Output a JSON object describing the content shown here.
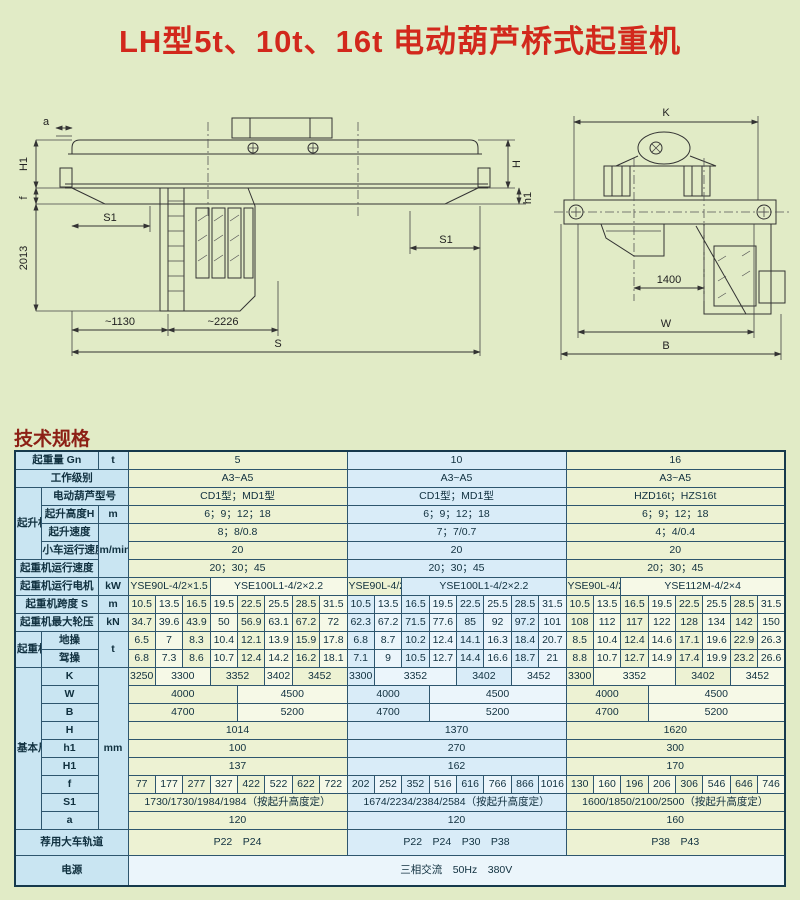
{
  "page": {
    "title": "LH型5t、10t、16t 电动葫芦桥式起重机",
    "section_heading": "技术规格"
  },
  "colors": {
    "title_red": "#d2281c",
    "heading_maroon": "#8c2015",
    "table_border": "#2e566e",
    "label_bg": "#c9e5f2",
    "green_bg": "#edf2d3",
    "blue_bg": "#d9ecf8",
    "page_bg": "#e1ebc6"
  },
  "drawing_left": {
    "name": "bridge crane side view",
    "labels": {
      "dim_a": "a",
      "dim_H1": "H1",
      "dim_f": "f",
      "dim_2013": "2013",
      "dim_S1_left": "S1",
      "dim_1130": "~1130",
      "dim_2226": "~2226",
      "dim_S": "S",
      "dim_H": "H",
      "dim_h1": "h1",
      "dim_S1_right": "S1"
    }
  },
  "drawing_right": {
    "name": "bridge crane end view",
    "labels": {
      "dim_K": "K",
      "dim_1400": "1400",
      "dim_W": "W",
      "dim_B": "B"
    }
  },
  "table": {
    "rows": [
      {
        "cells": [
          {
            "t": "起重量 Gn",
            "c": 2,
            "k": "lab"
          },
          {
            "t": "t",
            "k": "lab"
          },
          {
            "t": "5",
            "c": 8,
            "k": "g"
          },
          {
            "t": "10",
            "c": 8,
            "k": "b"
          },
          {
            "t": "16",
            "c": 8,
            "k": "g"
          }
        ]
      },
      {
        "cells": [
          {
            "t": "工作级别",
            "c": 3,
            "k": "lab"
          },
          {
            "t": "A3~A5",
            "c": 8,
            "k": "g"
          },
          {
            "t": "A3~A5",
            "c": 8,
            "k": "b"
          },
          {
            "t": "A3~A5",
            "c": 8,
            "k": "g"
          }
        ]
      },
      {
        "cells": [
          {
            "t": "起升机构",
            "r": 4,
            "k": "lab"
          },
          {
            "t": "电动葫芦型号",
            "c": 2,
            "k": "lab"
          },
          {
            "t": "CD1型；MD1型",
            "c": 8,
            "k": "g"
          },
          {
            "t": "CD1型；MD1型",
            "c": 8,
            "k": "b"
          },
          {
            "t": "HZD16t；HZS16t",
            "c": 8,
            "k": "g"
          }
        ]
      },
      {
        "cells": [
          {
            "t": "起升高度H",
            "k": "lab"
          },
          {
            "t": "m",
            "k": "lab"
          },
          {
            "t": "6；9；12；18",
            "c": 8,
            "k": "g"
          },
          {
            "t": "6；9；12；18",
            "c": 8,
            "k": "b"
          },
          {
            "t": "6；9；12；18",
            "c": 8,
            "k": "g"
          }
        ]
      },
      {
        "cells": [
          {
            "t": "起升速度",
            "k": "lab"
          },
          {
            "t": "m/min",
            "r": 3,
            "k": "lab"
          },
          {
            "t": "8；8/0.8",
            "c": 8,
            "k": "g"
          },
          {
            "t": "7；7/0.7",
            "c": 8,
            "k": "b"
          },
          {
            "t": "4；4/0.4",
            "c": 8,
            "k": "g"
          }
        ]
      },
      {
        "cells": [
          {
            "t": "小车运行速度",
            "k": "lab sm"
          },
          {
            "t": "20",
            "c": 8,
            "k": "g"
          },
          {
            "t": "20",
            "c": 8,
            "k": "b"
          },
          {
            "t": "20",
            "c": 8,
            "k": "g"
          }
        ]
      },
      {
        "cells": [
          {
            "t": "起重机运行速度",
            "c": 2,
            "k": "lab"
          },
          {
            "t": "20；30；45",
            "c": 8,
            "k": "g"
          },
          {
            "t": "20；30；45",
            "c": 8,
            "k": "b"
          },
          {
            "t": "20；30；45",
            "c": 8,
            "k": "g"
          }
        ]
      },
      {
        "cells": [
          {
            "t": "起重机运行电机",
            "c": 2,
            "k": "lab"
          },
          {
            "t": "kW",
            "k": "lab"
          },
          {
            "t": "YSE90L-4/2×1.5",
            "c": 3,
            "k": "g sm"
          },
          {
            "t": "YSE100L1-4/2×2.2",
            "c": 5,
            "k": "gl sm"
          },
          {
            "t": "YSE90L-4/2×1.5",
            "c": 2,
            "k": "g sm"
          },
          {
            "t": "YSE100L1-4/2×2.2",
            "c": 6,
            "k": "b sm"
          },
          {
            "t": "YSE90L-4/2×1.5",
            "c": 2,
            "k": "g sm"
          },
          {
            "t": "YSE112M-4/2×4",
            "c": 6,
            "k": "gl sm"
          }
        ]
      },
      {
        "cells": [
          {
            "t": "起重机跨度 S",
            "c": 2,
            "k": "lab"
          },
          {
            "t": "m",
            "k": "lab"
          },
          {
            "t": "10.5",
            "k": "g"
          },
          {
            "t": "13.5",
            "k": "gl"
          },
          {
            "t": "16.5",
            "k": "g"
          },
          {
            "t": "19.5",
            "k": "gl"
          },
          {
            "t": "22.5",
            "k": "g"
          },
          {
            "t": "25.5",
            "k": "gl"
          },
          {
            "t": "28.5",
            "k": "g"
          },
          {
            "t": "31.5",
            "k": "gl"
          },
          {
            "t": "10.5",
            "k": "b"
          },
          {
            "t": "13.5",
            "k": "bl"
          },
          {
            "t": "16.5",
            "k": "b"
          },
          {
            "t": "19.5",
            "k": "bl"
          },
          {
            "t": "22.5",
            "k": "b"
          },
          {
            "t": "25.5",
            "k": "bl"
          },
          {
            "t": "28.5",
            "k": "b"
          },
          {
            "t": "31.5",
            "k": "bl"
          },
          {
            "t": "10.5",
            "k": "g"
          },
          {
            "t": "13.5",
            "k": "gl"
          },
          {
            "t": "16.5",
            "k": "g"
          },
          {
            "t": "19.5",
            "k": "gl"
          },
          {
            "t": "22.5",
            "k": "g"
          },
          {
            "t": "25.5",
            "k": "gl"
          },
          {
            "t": "28.5",
            "k": "g"
          },
          {
            "t": "31.5",
            "k": "gl"
          }
        ]
      },
      {
        "cells": [
          {
            "t": "起重机最大轮压",
            "c": 2,
            "k": "lab"
          },
          {
            "t": "kN",
            "k": "lab"
          },
          {
            "t": "34.7",
            "k": "g"
          },
          {
            "t": "39.6",
            "k": "gl"
          },
          {
            "t": "43.9",
            "k": "g"
          },
          {
            "t": "50",
            "k": "gl"
          },
          {
            "t": "56.9",
            "k": "g"
          },
          {
            "t": "63.1",
            "k": "gl"
          },
          {
            "t": "67.2",
            "k": "g"
          },
          {
            "t": "72",
            "k": "gl"
          },
          {
            "t": "62.3",
            "k": "b"
          },
          {
            "t": "67.2",
            "k": "bl"
          },
          {
            "t": "71.5",
            "k": "b"
          },
          {
            "t": "77.6",
            "k": "bl"
          },
          {
            "t": "85",
            "k": "b"
          },
          {
            "t": "92",
            "k": "bl"
          },
          {
            "t": "97.2",
            "k": "b"
          },
          {
            "t": "101",
            "k": "bl"
          },
          {
            "t": "108",
            "k": "g"
          },
          {
            "t": "112",
            "k": "gl"
          },
          {
            "t": "117",
            "k": "g"
          },
          {
            "t": "122",
            "k": "gl"
          },
          {
            "t": "128",
            "k": "g"
          },
          {
            "t": "134",
            "k": "gl"
          },
          {
            "t": "142",
            "k": "g"
          },
          {
            "t": "150",
            "k": "gl"
          }
        ]
      },
      {
        "cells": [
          {
            "t": "起重机总重",
            "r": 2,
            "k": "lab"
          },
          {
            "t": "地操",
            "k": "lab"
          },
          {
            "t": "t",
            "r": 2,
            "k": "lab"
          },
          {
            "t": "6.5",
            "k": "g"
          },
          {
            "t": "7",
            "k": "gl"
          },
          {
            "t": "8.3",
            "k": "g"
          },
          {
            "t": "10.4",
            "k": "gl"
          },
          {
            "t": "12.1",
            "k": "g"
          },
          {
            "t": "13.9",
            "k": "gl"
          },
          {
            "t": "15.9",
            "k": "g"
          },
          {
            "t": "17.8",
            "k": "gl"
          },
          {
            "t": "6.8",
            "k": "b"
          },
          {
            "t": "8.7",
            "k": "bl"
          },
          {
            "t": "10.2",
            "k": "b"
          },
          {
            "t": "12.4",
            "k": "bl"
          },
          {
            "t": "14.1",
            "k": "b"
          },
          {
            "t": "16.3",
            "k": "bl"
          },
          {
            "t": "18.4",
            "k": "b"
          },
          {
            "t": "20.7",
            "k": "bl"
          },
          {
            "t": "8.5",
            "k": "g"
          },
          {
            "t": "10.4",
            "k": "gl"
          },
          {
            "t": "12.4",
            "k": "g"
          },
          {
            "t": "14.6",
            "k": "gl"
          },
          {
            "t": "17.1",
            "k": "g"
          },
          {
            "t": "19.6",
            "k": "gl"
          },
          {
            "t": "22.9",
            "k": "g"
          },
          {
            "t": "26.3",
            "k": "gl"
          }
        ]
      },
      {
        "cells": [
          {
            "t": "驾操",
            "k": "lab"
          },
          {
            "t": "6.8",
            "k": "g"
          },
          {
            "t": "7.3",
            "k": "gl"
          },
          {
            "t": "8.6",
            "k": "g"
          },
          {
            "t": "10.7",
            "k": "gl"
          },
          {
            "t": "12.4",
            "k": "g"
          },
          {
            "t": "14.2",
            "k": "gl"
          },
          {
            "t": "16.2",
            "k": "g"
          },
          {
            "t": "18.1",
            "k": "gl"
          },
          {
            "t": "7.1",
            "k": "b"
          },
          {
            "t": "9",
            "k": "bl"
          },
          {
            "t": "10.5",
            "k": "b"
          },
          {
            "t": "12.7",
            "k": "bl"
          },
          {
            "t": "14.4",
            "k": "b"
          },
          {
            "t": "16.6",
            "k": "bl"
          },
          {
            "t": "18.7",
            "k": "b"
          },
          {
            "t": "21",
            "k": "bl"
          },
          {
            "t": "8.8",
            "k": "g"
          },
          {
            "t": "10.7",
            "k": "gl"
          },
          {
            "t": "12.7",
            "k": "g"
          },
          {
            "t": "14.9",
            "k": "gl"
          },
          {
            "t": "17.4",
            "k": "g"
          },
          {
            "t": "19.9",
            "k": "gl"
          },
          {
            "t": "23.2",
            "k": "g"
          },
          {
            "t": "26.6",
            "k": "gl"
          }
        ]
      },
      {
        "cells": [
          {
            "t": "基本尺寸",
            "r": 9,
            "k": "lab"
          },
          {
            "t": "K",
            "k": "lab"
          },
          {
            "t": "mm",
            "r": 9,
            "k": "lab"
          },
          {
            "t": "3250",
            "k": "g"
          },
          {
            "t": "3300",
            "c": 2,
            "k": "gl"
          },
          {
            "t": "3352",
            "c": 2,
            "k": "g"
          },
          {
            "t": "3402",
            "k": "gl"
          },
          {
            "t": "3452",
            "c": 2,
            "k": "g"
          },
          {
            "t": "3300",
            "k": "b"
          },
          {
            "t": "3352",
            "c": 3,
            "k": "bl"
          },
          {
            "t": "3402",
            "c": 2,
            "k": "b"
          },
          {
            "t": "3452",
            "c": 2,
            "k": "bl"
          },
          {
            "t": "3300",
            "k": "g"
          },
          {
            "t": "3352",
            "c": 3,
            "k": "gl"
          },
          {
            "t": "3402",
            "c": 2,
            "k": "g"
          },
          {
            "t": "3452",
            "c": 2,
            "k": "gl"
          }
        ]
      },
      {
        "cells": [
          {
            "t": "W",
            "k": "lab"
          },
          {
            "t": "4000",
            "c": 4,
            "k": "g"
          },
          {
            "t": "4500",
            "c": 4,
            "k": "gl"
          },
          {
            "t": "4000",
            "c": 3,
            "k": "b"
          },
          {
            "t": "4500",
            "c": 5,
            "k": "bl"
          },
          {
            "t": "4000",
            "c": 3,
            "k": "g"
          },
          {
            "t": "4500",
            "c": 5,
            "k": "gl"
          }
        ]
      },
      {
        "cells": [
          {
            "t": "B",
            "k": "lab"
          },
          {
            "t": "4700",
            "c": 4,
            "k": "g"
          },
          {
            "t": "5200",
            "c": 4,
            "k": "gl"
          },
          {
            "t": "4700",
            "c": 3,
            "k": "b"
          },
          {
            "t": "5200",
            "c": 5,
            "k": "bl"
          },
          {
            "t": "4700",
            "c": 3,
            "k": "g"
          },
          {
            "t": "5200",
            "c": 5,
            "k": "gl"
          }
        ]
      },
      {
        "cells": [
          {
            "t": "H",
            "k": "lab"
          },
          {
            "t": "1014",
            "c": 8,
            "k": "g"
          },
          {
            "t": "1370",
            "c": 8,
            "k": "b"
          },
          {
            "t": "1620",
            "c": 8,
            "k": "g"
          }
        ]
      },
      {
        "cells": [
          {
            "t": "h1",
            "k": "lab"
          },
          {
            "t": "100",
            "c": 8,
            "k": "g"
          },
          {
            "t": "270",
            "c": 8,
            "k": "b"
          },
          {
            "t": "300",
            "c": 8,
            "k": "g"
          }
        ]
      },
      {
        "cells": [
          {
            "t": "H1",
            "k": "lab"
          },
          {
            "t": "137",
            "c": 8,
            "k": "g"
          },
          {
            "t": "162",
            "c": 8,
            "k": "b"
          },
          {
            "t": "170",
            "c": 8,
            "k": "g"
          }
        ]
      },
      {
        "cells": [
          {
            "t": "f",
            "k": "lab"
          },
          {
            "t": "77",
            "k": "g"
          },
          {
            "t": "177",
            "k": "gl"
          },
          {
            "t": "277",
            "k": "g"
          },
          {
            "t": "327",
            "k": "gl"
          },
          {
            "t": "422",
            "k": "g"
          },
          {
            "t": "522",
            "k": "gl"
          },
          {
            "t": "622",
            "k": "g"
          },
          {
            "t": "722",
            "k": "gl"
          },
          {
            "t": "202",
            "k": "b"
          },
          {
            "t": "252",
            "k": "bl"
          },
          {
            "t": "352",
            "k": "b"
          },
          {
            "t": "516",
            "k": "bl"
          },
          {
            "t": "616",
            "k": "b"
          },
          {
            "t": "766",
            "k": "bl"
          },
          {
            "t": "866",
            "k": "b"
          },
          {
            "t": "1016",
            "k": "bl"
          },
          {
            "t": "130",
            "k": "g"
          },
          {
            "t": "160",
            "k": "gl"
          },
          {
            "t": "196",
            "k": "g"
          },
          {
            "t": "206",
            "k": "gl"
          },
          {
            "t": "306",
            "k": "g"
          },
          {
            "t": "546",
            "k": "gl"
          },
          {
            "t": "646",
            "k": "g"
          },
          {
            "t": "746",
            "k": "gl"
          }
        ]
      },
      {
        "cells": [
          {
            "t": "S1",
            "k": "lab"
          },
          {
            "t": "1730/1730/1984/1984（按起升高度定）",
            "c": 8,
            "k": "g sm"
          },
          {
            "t": "1674/2234/2384/2584（按起升高度定）",
            "c": 8,
            "k": "b sm"
          },
          {
            "t": "1600/1850/2100/2500（按起升高度定）",
            "c": 8,
            "k": "g sm"
          }
        ]
      },
      {
        "cells": [
          {
            "t": "a",
            "k": "lab"
          },
          {
            "t": "120",
            "c": 8,
            "k": "g"
          },
          {
            "t": "120",
            "c": 8,
            "k": "b"
          },
          {
            "t": "160",
            "c": 8,
            "k": "g"
          }
        ]
      },
      {
        "cells": [
          {
            "t": "荐用大车轨道",
            "c": 3,
            "k": "lab"
          },
          {
            "t": "P22　P24",
            "c": 8,
            "k": "g"
          },
          {
            "t": "P22　P24　P30　P38",
            "c": 8,
            "k": "b"
          },
          {
            "t": "P38　P43",
            "c": 8,
            "k": "g"
          }
        ]
      },
      {
        "cells": [
          {
            "t": "电源",
            "c": 3,
            "k": "lab"
          },
          {
            "t": "三相交流　50Hz　380V",
            "c": 24,
            "k": "bl"
          }
        ]
      }
    ]
  }
}
